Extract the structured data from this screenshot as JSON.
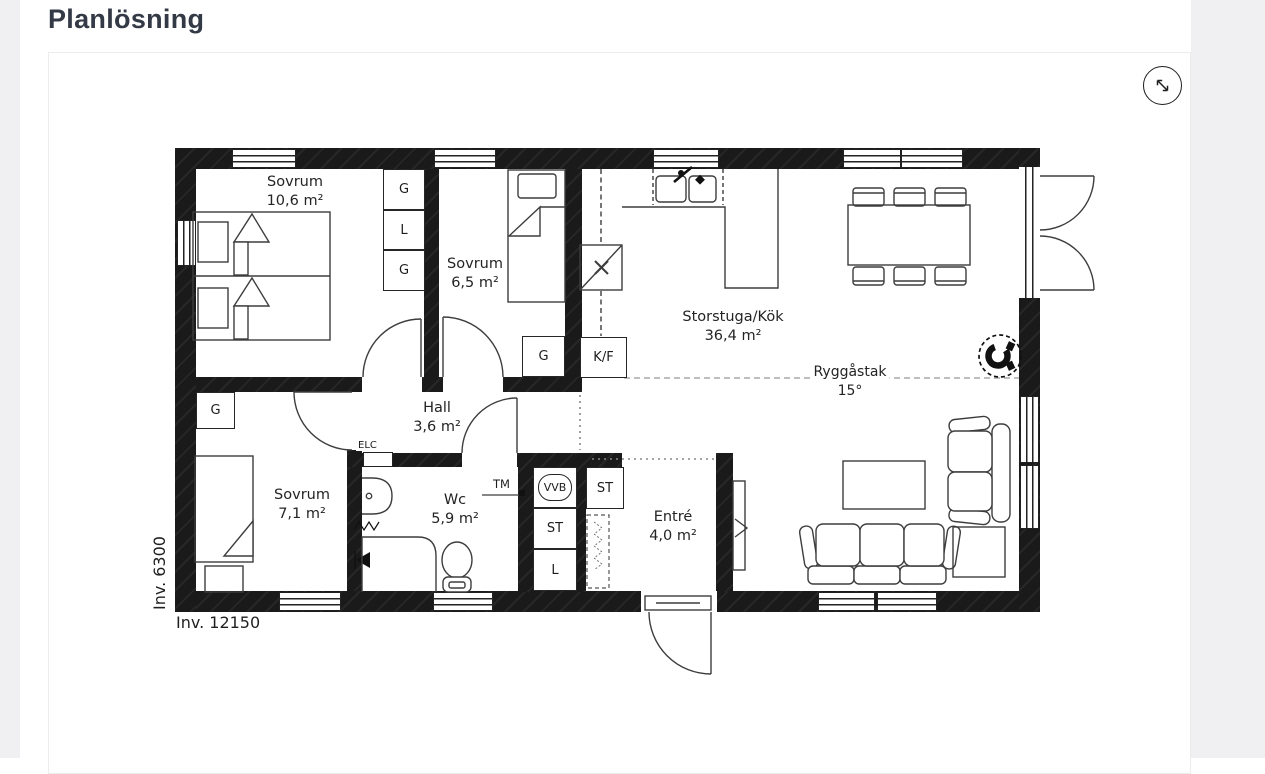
{
  "page": {
    "title": "Planlösning"
  },
  "toolbar": {
    "expand_icon": "diagonal-resize-arrow"
  },
  "plan": {
    "rooms": {
      "sovrum_106": {
        "name": "Sovrum",
        "area": "10,6 m²"
      },
      "sovrum_65": {
        "name": "Sovrum",
        "area": "6,5 m²"
      },
      "storstuga": {
        "name": "Storstuga/Kök",
        "area": "36,4 m²"
      },
      "hall": {
        "name": "Hall",
        "area": "3,6 m²"
      },
      "sovrum_71": {
        "name": "Sovrum",
        "area": "7,1 m²"
      },
      "wc": {
        "name": "Wc",
        "area": "5,9 m²"
      },
      "entre": {
        "name": "Entré",
        "area": "4,0 m²"
      }
    },
    "ceiling": {
      "label": "Ryggåstak",
      "angle": "15°"
    },
    "dimensions": {
      "width": "Inv. 12150",
      "depth": "Inv. 6300"
    },
    "fixtures": {
      "wardrobe": "G",
      "linen": "L",
      "storage": "ST",
      "water_heater": "VVB",
      "fridge_freezer": "K/F",
      "washing_machine": "TM",
      "electrical_cabinet": "ELC"
    }
  }
}
